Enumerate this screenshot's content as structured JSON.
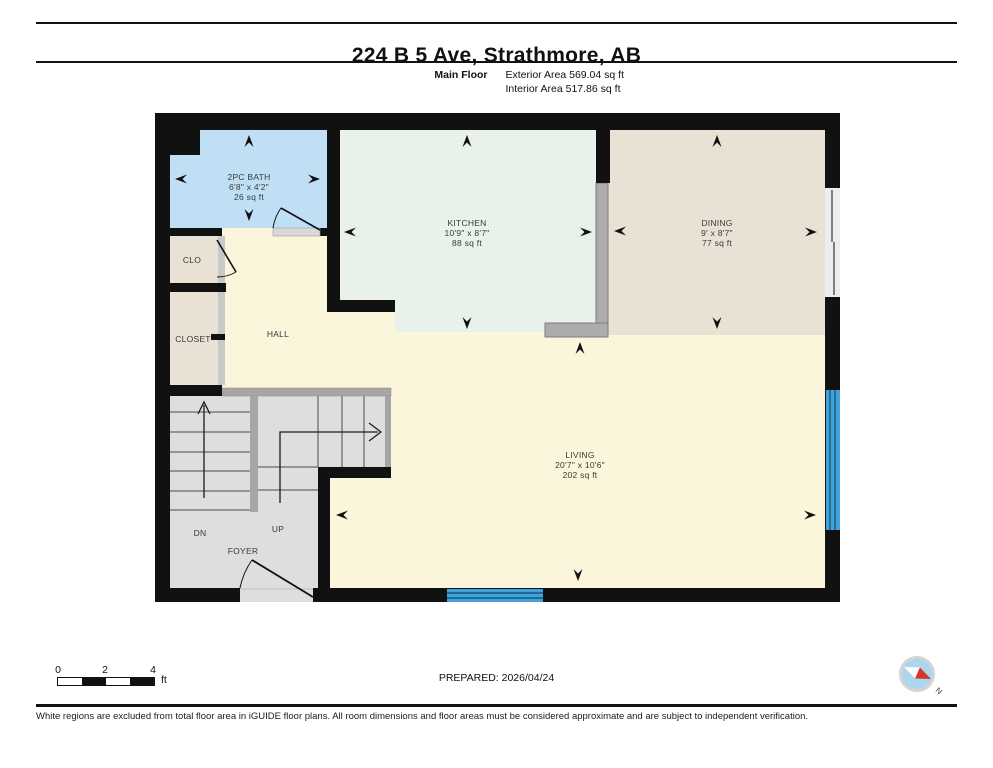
{
  "header": {
    "title": "224 B 5 Ave, Strathmore, AB",
    "floor_label": "Main Floor",
    "exterior_area": "Exterior Area 569.04 sq ft",
    "interior_area": "Interior Area 517.86 sq ft"
  },
  "rooms": {
    "bath": {
      "name": "2PC BATH",
      "dims": "6'8\" x 4'2\"",
      "area": "26 sq ft"
    },
    "kitchen": {
      "name": "KITCHEN",
      "dims": "10'9\" x 8'7\"",
      "area": "88 sq ft"
    },
    "dining": {
      "name": "DINING",
      "dims": "9' x 8'7\"",
      "area": "77 sq ft"
    },
    "living": {
      "name": "LIVING",
      "dims": "20'7\" x 10'6\"",
      "area": "202 sq ft"
    },
    "hall": {
      "name": "HALL"
    },
    "clo": {
      "name": "CLO"
    },
    "closet": {
      "name": "CLOSET"
    },
    "foyer": {
      "name": "FOYER"
    },
    "stairs": {
      "down": "DN",
      "up": "UP"
    }
  },
  "scale_bar": {
    "tick_0": "0",
    "tick_2": "2",
    "tick_4": "4",
    "unit": "ft"
  },
  "footer": {
    "prepared": "PREPARED: 2026/04/24",
    "compass_north": "N",
    "disclaimer": "White regions are excluded from total floor area in iGUIDE floor plans. All room dimensions and floor areas must be considered approximate and are subject to independent verification."
  },
  "colors": {
    "wall_black": "#111111",
    "bath_blue": "#BFE0F4",
    "kitchen_mint": "#E9F1EB",
    "dining_beige": "#E9E1D4",
    "living_cream": "#FBF5DC",
    "stairs_gray": "#DEDEDE",
    "banister_gray": "#A6A6A6",
    "counter_gray": "#ACACAC",
    "window_blue": "#3FA3D9",
    "compass_blue": "#ABD7EE",
    "compass_red": "#D63427"
  }
}
